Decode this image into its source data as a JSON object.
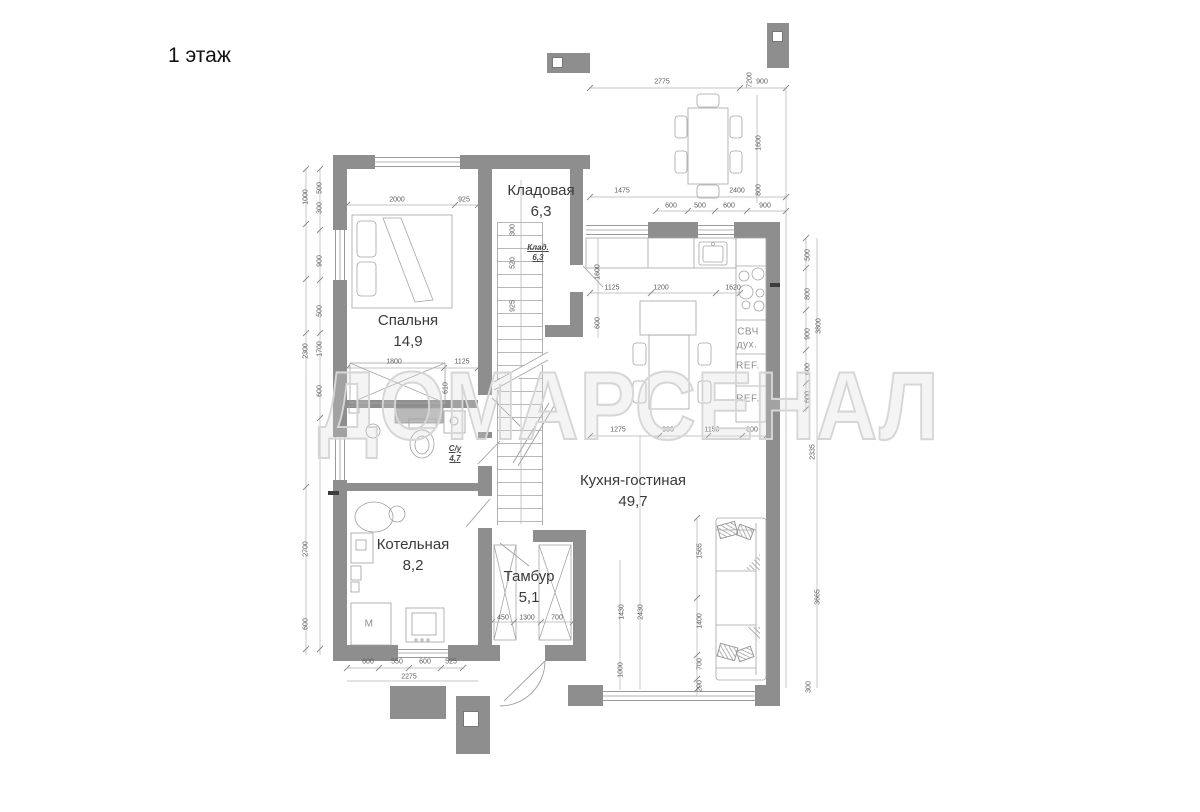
{
  "title": "1 этаж",
  "watermark": "ДОМАРСЕНАЛ",
  "rooms": [
    {
      "name": "Спальня",
      "area": "14,9",
      "x": 408,
      "y": 310
    },
    {
      "name": "Кладовая",
      "area": "6,3",
      "x": 541,
      "y": 180
    },
    {
      "name": "Кухня-гостиная",
      "area": "49,7",
      "x": 633,
      "y": 470
    },
    {
      "name": "Котельная",
      "area": "8,2",
      "x": 413,
      "y": 534
    },
    {
      "name": "Тамбур",
      "area": "5,1",
      "x": 529,
      "y": 566
    }
  ],
  "small_rooms": [
    {
      "name": "Клад.",
      "area": "6,3",
      "x": 538,
      "y": 243
    },
    {
      "name": "С/у",
      "area": "4,7",
      "x": 455,
      "y": 444
    }
  ],
  "appliances": [
    {
      "label": "СВЧ",
      "x": 748,
      "y": 332
    },
    {
      "label": "дух.",
      "x": 747,
      "y": 345
    },
    {
      "label": "REF.",
      "x": 748,
      "y": 366
    },
    {
      "label": "REF.",
      "x": 748,
      "y": 399
    },
    {
      "label": "М",
      "x": 369,
      "y": 624
    }
  ],
  "dims": [
    {
      "t": "2775",
      "x": 662,
      "y": 82
    },
    {
      "t": "900",
      "x": 762,
      "y": 82
    },
    {
      "t": "7200",
      "x": 750,
      "y": 80,
      "r": 1
    },
    {
      "t": "1475",
      "x": 622,
      "y": 191
    },
    {
      "t": "2400",
      "x": 737,
      "y": 191
    },
    {
      "t": "600",
      "x": 671,
      "y": 206
    },
    {
      "t": "500",
      "x": 700,
      "y": 206
    },
    {
      "t": "600",
      "x": 729,
      "y": 206
    },
    {
      "t": "900",
      "x": 765,
      "y": 206
    },
    {
      "t": "1600",
      "x": 759,
      "y": 143,
      "r": 1
    },
    {
      "t": "800",
      "x": 759,
      "y": 190,
      "r": 1
    },
    {
      "t": "2000",
      "x": 397,
      "y": 200
    },
    {
      "t": "925",
      "x": 464,
      "y": 200
    },
    {
      "t": "300",
      "x": 513,
      "y": 230,
      "r": 1
    },
    {
      "t": "520",
      "x": 513,
      "y": 263,
      "r": 1
    },
    {
      "t": "925",
      "x": 513,
      "y": 306,
      "r": 1
    },
    {
      "t": "1800",
      "x": 394,
      "y": 362
    },
    {
      "t": "1125",
      "x": 462,
      "y": 362
    },
    {
      "t": "610",
      "x": 446,
      "y": 388,
      "r": 1
    },
    {
      "t": "500",
      "x": 320,
      "y": 188,
      "r": 1
    },
    {
      "t": "300",
      "x": 320,
      "y": 208,
      "r": 1
    },
    {
      "t": "900",
      "x": 320,
      "y": 261,
      "r": 1
    },
    {
      "t": "500",
      "x": 320,
      "y": 311,
      "r": 1
    },
    {
      "t": "1700",
      "x": 320,
      "y": 349,
      "r": 1
    },
    {
      "t": "600",
      "x": 320,
      "y": 391,
      "r": 1
    },
    {
      "t": "1000",
      "x": 306,
      "y": 197,
      "r": 1
    },
    {
      "t": "2300",
      "x": 306,
      "y": 351,
      "r": 1
    },
    {
      "t": "2700",
      "x": 306,
      "y": 549,
      "r": 1
    },
    {
      "t": "600",
      "x": 306,
      "y": 624,
      "r": 1
    },
    {
      "t": "1125",
      "x": 612,
      "y": 288
    },
    {
      "t": "1200",
      "x": 661,
      "y": 288
    },
    {
      "t": "1620",
      "x": 733,
      "y": 288
    },
    {
      "t": "1600",
      "x": 598,
      "y": 272,
      "r": 1
    },
    {
      "t": "600",
      "x": 598,
      "y": 323,
      "r": 1
    },
    {
      "t": "500",
      "x": 808,
      "y": 255,
      "r": 1
    },
    {
      "t": "800",
      "x": 808,
      "y": 294,
      "r": 1
    },
    {
      "t": "900",
      "x": 808,
      "y": 334,
      "r": 1
    },
    {
      "t": "600",
      "x": 808,
      "y": 369,
      "r": 1
    },
    {
      "t": "600",
      "x": 808,
      "y": 397,
      "r": 1
    },
    {
      "t": "3800",
      "x": 819,
      "y": 326,
      "r": 1
    },
    {
      "t": "2335",
      "x": 813,
      "y": 452,
      "r": 1
    },
    {
      "t": "1275",
      "x": 618,
      "y": 430
    },
    {
      "t": "900",
      "x": 668,
      "y": 430
    },
    {
      "t": "1150",
      "x": 712,
      "y": 430
    },
    {
      "t": "600",
      "x": 752,
      "y": 430
    },
    {
      "t": "1565",
      "x": 700,
      "y": 551,
      "r": 1
    },
    {
      "t": "1400",
      "x": 700,
      "y": 621,
      "r": 1
    },
    {
      "t": "700",
      "x": 700,
      "y": 664,
      "r": 1
    },
    {
      "t": "200",
      "x": 700,
      "y": 686,
      "r": 1
    },
    {
      "t": "3665",
      "x": 818,
      "y": 597,
      "r": 1
    },
    {
      "t": "300",
      "x": 809,
      "y": 687,
      "r": 1
    },
    {
      "t": "1430",
      "x": 622,
      "y": 612,
      "r": 1
    },
    {
      "t": "2430",
      "x": 641,
      "y": 612,
      "r": 1
    },
    {
      "t": "1000",
      "x": 621,
      "y": 670,
      "r": 1
    },
    {
      "t": "450",
      "x": 503,
      "y": 618
    },
    {
      "t": "1300",
      "x": 527,
      "y": 618
    },
    {
      "t": "700",
      "x": 557,
      "y": 618
    },
    {
      "t": "600",
      "x": 368,
      "y": 662
    },
    {
      "t": "550",
      "x": 397,
      "y": 662
    },
    {
      "t": "600",
      "x": 425,
      "y": 662
    },
    {
      "t": "525",
      "x": 451,
      "y": 662
    },
    {
      "t": "2275",
      "x": 409,
      "y": 677
    }
  ]
}
